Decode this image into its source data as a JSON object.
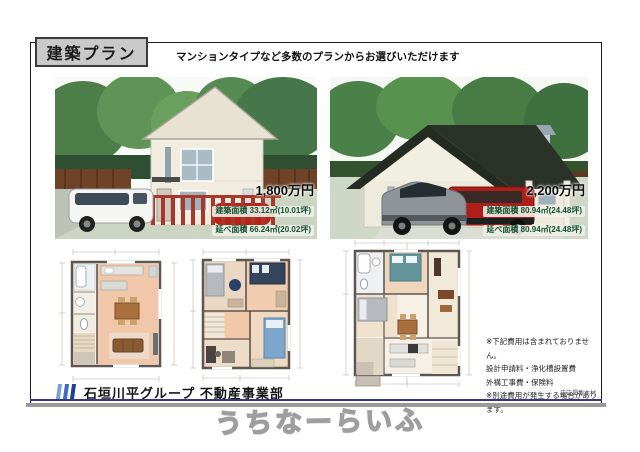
{
  "header": {
    "title": "建築プラン",
    "subtitle": "マンションタイプなど多数のプランからお選びいただけます"
  },
  "plans": [
    {
      "price": "1,800万円",
      "area1_label": "建築面積",
      "area1_value": "33.12㎡(10.01坪)",
      "area2_label": "延べ面積",
      "area2_value": "66.24㎡(20.02坪)"
    },
    {
      "price": "2,200万円",
      "area1_label": "建築面積",
      "area1_value": "80.94㎡(24.48坪)",
      "area2_label": "延べ面積",
      "area2_value": "80.94㎡(24.48坪)"
    }
  ],
  "notes": {
    "lines": [
      "※下記費用は含まれておりません。",
      "設計申請料・浄化槽設置費",
      "外構工事費・保険料",
      "※別途費用が発生する場合があります。"
    ],
    "ad_note": "広告掲載木村"
  },
  "footer": {
    "company": "石垣川平グループ 不動産事業部",
    "watermark": "うちなーらいふ"
  },
  "colors": {
    "title_box_bg": "#c9c9c9",
    "accent_navy": "#2b3a8c",
    "price_green": "#14532d",
    "logo_blues": [
      "#7aa0dc",
      "#3f6bc4",
      "#1f3f9e"
    ],
    "frame": "#1a1a1a"
  }
}
